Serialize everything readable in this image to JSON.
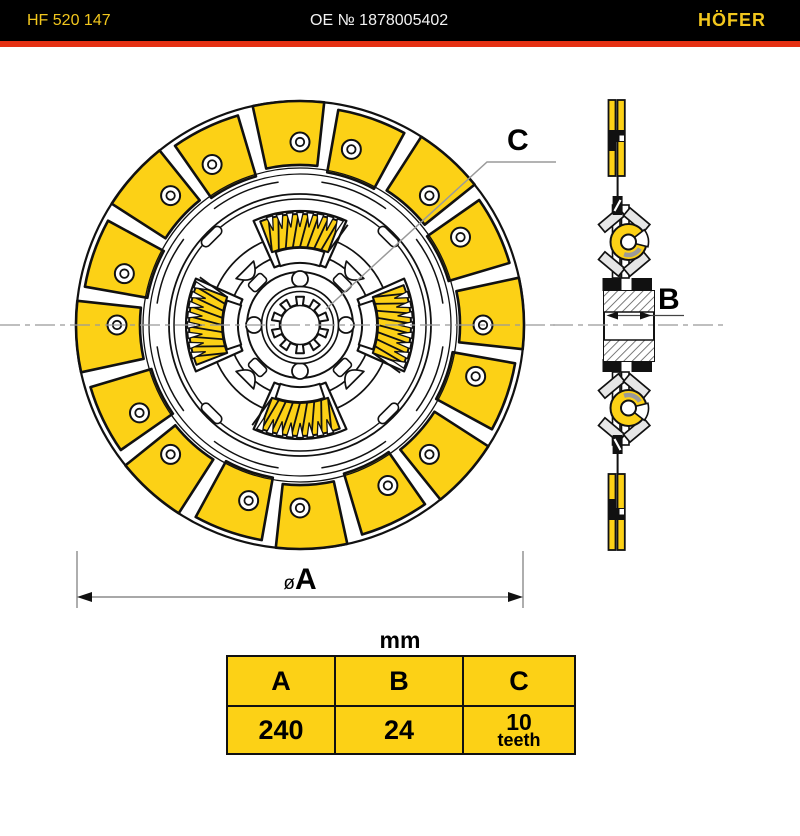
{
  "header": {
    "part_code": "HF 520 147",
    "oe_number": "OE № 1878005402",
    "brand": "HÖFER"
  },
  "drawing_labels": {
    "c": "C",
    "b": "B",
    "a_prefix": "ø",
    "a": "A",
    "units_title": "mm"
  },
  "table": {
    "headers": [
      "A",
      "B",
      "C"
    ],
    "values": {
      "a": "240",
      "b": "24",
      "c": "10",
      "c_unit": "teeth"
    }
  },
  "dimensions": {
    "a_mm": 240,
    "b_mm": 24,
    "c_teeth": 10
  },
  "colors": {
    "accent_yellow": "#FCD116",
    "brand_yellow": "#F2C71D",
    "stripe_red": "#E53012",
    "header_bg": "#000000",
    "line_black": "#111111",
    "dim_gray": "#8C8C8C",
    "shade_gray": "#E6E6E6"
  }
}
